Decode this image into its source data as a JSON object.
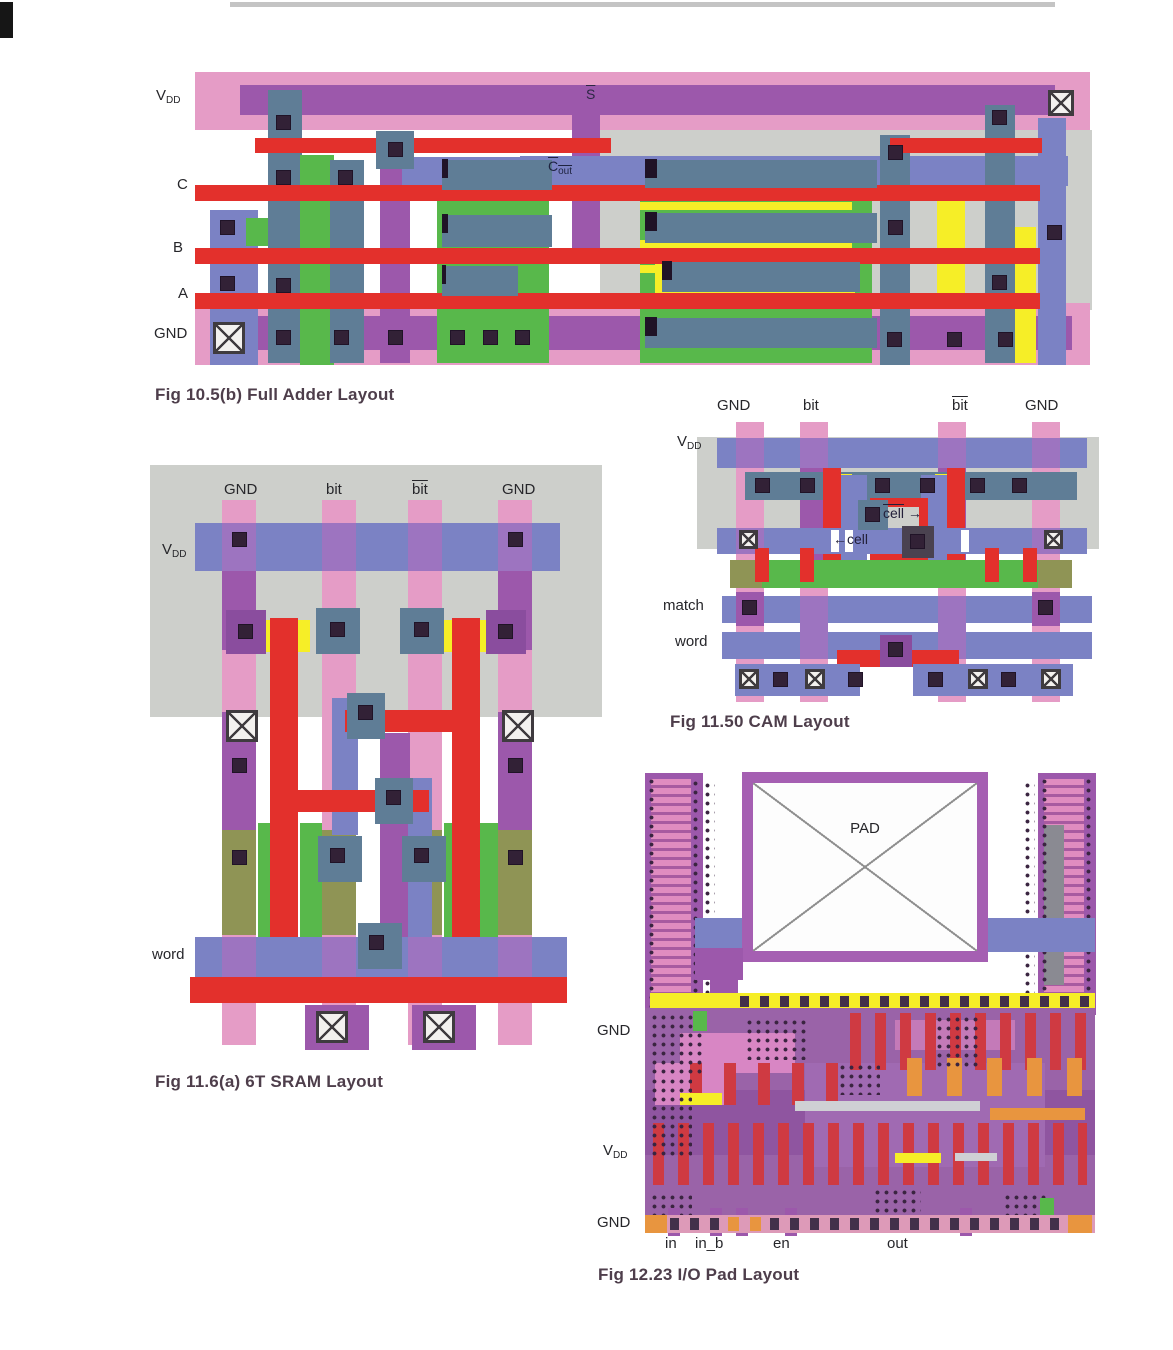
{
  "palette": {
    "pink": "#e59cc6",
    "purple": "#9c58ab",
    "purple_dark": "#8a4d9e",
    "red": "#e3302c",
    "blue": "#7b82c4",
    "slate": "#5f7d96",
    "green": "#58b84b",
    "green_light": "#7fbf6a",
    "yellow": "#f6ee27",
    "gray": "#cdcfcb",
    "olive": "#8f9455",
    "orange": "#e8953f",
    "violet_cross": "#9d74c0",
    "contact": "#322136"
  },
  "fa": {
    "caption": "Fig 10.5(b)  Full Adder Layout",
    "labels": {
      "vdd_v": "V",
      "vdd_dd": "DD",
      "c": "C",
      "b": "B",
      "a": "A",
      "gnd": "GND",
      "s_bar": "S",
      "cout_c": "C",
      "cout_sub": "out"
    }
  },
  "sram": {
    "caption": "Fig 11.6(a)  6T SRAM Layout",
    "labels": {
      "gnd_left": "GND",
      "bit": "bit",
      "bit_bar": "bit",
      "gnd_right": "GND",
      "vdd_v": "V",
      "vdd_dd": "DD",
      "word": "word"
    }
  },
  "cam": {
    "caption": "Fig 11.50 CAM Layout",
    "labels": {
      "gnd_left": "GND",
      "bit": "bit",
      "bit_bar": "bit",
      "gnd_right": "GND",
      "vdd_v": "V",
      "vdd_dd": "DD",
      "match": "match",
      "word": "word",
      "cell_bar": "cell",
      "cell": "cell",
      "arrow_right": "→",
      "arrow_left": "←"
    }
  },
  "iopad": {
    "caption": "Fig 12.23  I/O Pad Layout",
    "labels": {
      "pad": "PAD",
      "gnd_top": "GND",
      "vdd_v": "V",
      "vdd_dd": "DD",
      "gnd_bottom": "GND",
      "in": "in",
      "in_b": "in_b",
      "en": "en",
      "out": "out"
    }
  }
}
